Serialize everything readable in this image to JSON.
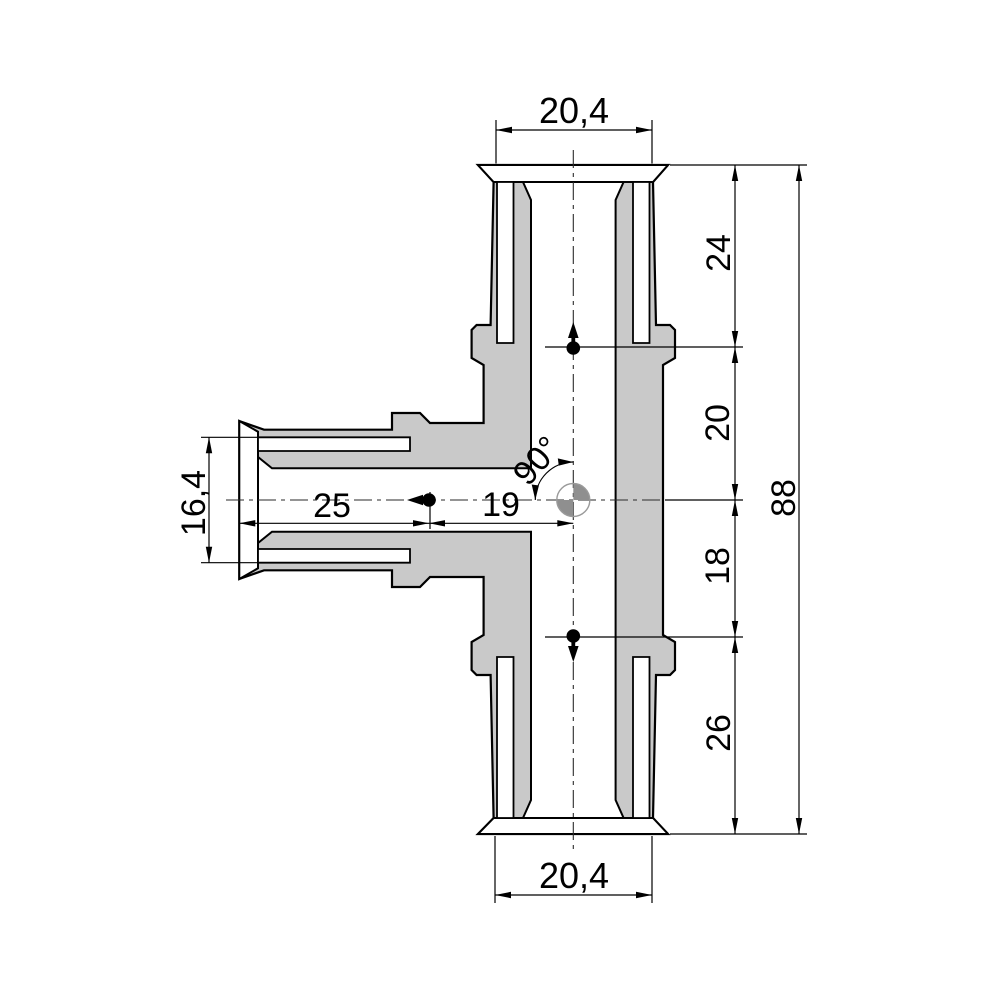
{
  "drawing": {
    "title": "tee-fitting-cross-section",
    "colors": {
      "body_fill": "#c9c9c9",
      "outline": "#000000",
      "background": "#ffffff",
      "centroid_gray": "#8f8f8f"
    },
    "dimensions": {
      "top_socket_width": "20,4",
      "bottom_socket_width": "20,4",
      "right_chain": [
        "24",
        "20",
        "18",
        "26"
      ],
      "overall_height": "88",
      "left_socket_diameter": "16,4",
      "left_insertion_depth": "25",
      "center_offset": "19",
      "branch_angle": "90°"
    }
  }
}
